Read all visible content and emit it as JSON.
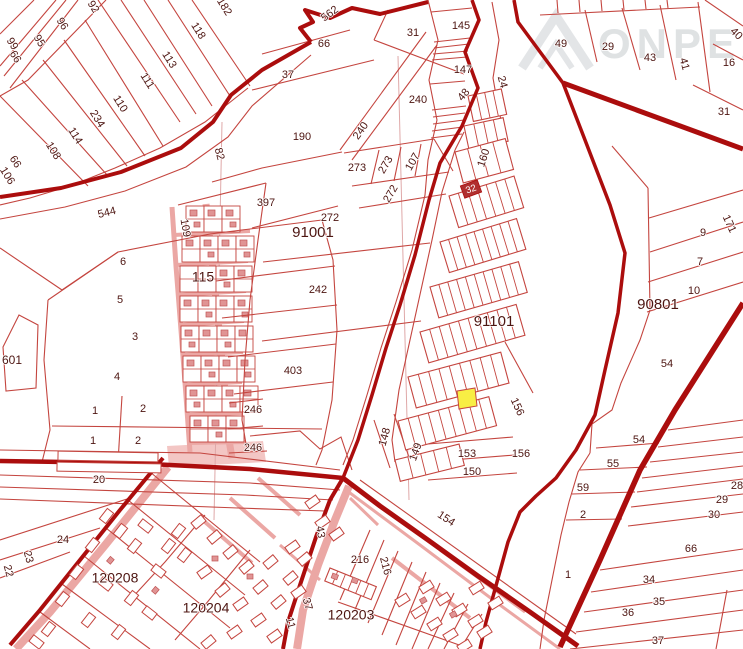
{
  "map": {
    "watermark": {
      "text": "ONPEA"
    },
    "colors": {
      "line": "#c4453f",
      "road": "#ab0d0d",
      "pink_fill": "#f3c6c4",
      "pink_line": "#eba7a4",
      "power_line": "#dfa8a8",
      "building": "#e09494",
      "building_edge": "#c05555",
      "label": "#4d1511",
      "highlight": "#f8ee44",
      "boxed_label_bg": "#b03030",
      "boxed_label_text": "#ffffff",
      "watermark": "#dcdfe1"
    },
    "boxed_label": {
      "t": "32",
      "x": 471,
      "y": 189,
      "r": -20
    },
    "highlighted_parcel": {
      "color": "#f8ee44"
    },
    "labels": [
      {
        "t": "99",
        "x": 12,
        "y": 44,
        "r": 58
      },
      {
        "t": "66",
        "x": 15,
        "y": 57,
        "r": 58
      },
      {
        "t": "95",
        "x": 39,
        "y": 41,
        "r": 58
      },
      {
        "t": "96",
        "x": 62,
        "y": 24,
        "r": 58
      },
      {
        "t": "92",
        "x": 93,
        "y": 7,
        "r": 58
      },
      {
        "t": "118",
        "x": 198,
        "y": 31,
        "r": 58
      },
      {
        "t": "113",
        "x": 169,
        "y": 60,
        "r": 58
      },
      {
        "t": "111",
        "x": 147,
        "y": 81,
        "r": 58
      },
      {
        "t": "110",
        "x": 120,
        "y": 104,
        "r": 58
      },
      {
        "t": "234",
        "x": 97,
        "y": 119,
        "r": 58
      },
      {
        "t": "114",
        "x": 75,
        "y": 136,
        "r": 58
      },
      {
        "t": "108",
        "x": 53,
        "y": 151,
        "r": 58
      },
      {
        "t": "66",
        "x": 15,
        "y": 162,
        "r": 58
      },
      {
        "t": "106",
        "x": 7,
        "y": 176,
        "r": 58
      },
      {
        "t": "182",
        "x": 224,
        "y": 7,
        "r": 58
      },
      {
        "t": "562",
        "x": 330,
        "y": 14,
        "r": -36
      },
      {
        "t": "66",
        "x": 324,
        "y": 44
      },
      {
        "t": "37",
        "x": 288,
        "y": 75
      },
      {
        "t": "31",
        "x": 413,
        "y": 33
      },
      {
        "t": "190",
        "x": 302,
        "y": 137
      },
      {
        "t": "240",
        "x": 418,
        "y": 100
      },
      {
        "t": "240",
        "x": 361,
        "y": 131,
        "r": -55
      },
      {
        "t": "273",
        "x": 357,
        "y": 168
      },
      {
        "t": "273",
        "x": 386,
        "y": 165,
        "r": -60
      },
      {
        "t": "107",
        "x": 413,
        "y": 162,
        "r": -60
      },
      {
        "t": "272",
        "x": 391,
        "y": 194,
        "r": -60
      },
      {
        "t": "272",
        "x": 330,
        "y": 218
      },
      {
        "t": "91001",
        "x": 313,
        "y": 233,
        "s": 15
      },
      {
        "t": "397",
        "x": 266,
        "y": 203
      },
      {
        "t": "242",
        "x": 318,
        "y": 290
      },
      {
        "t": "82",
        "x": 219,
        "y": 154,
        "r": 75
      },
      {
        "t": "109",
        "x": 185,
        "y": 228,
        "r": 80
      },
      {
        "t": "115",
        "x": 203,
        "y": 278,
        "s": 14
      },
      {
        "t": "544",
        "x": 107,
        "y": 213,
        "r": -14
      },
      {
        "t": "160",
        "x": 484,
        "y": 158,
        "r": -72
      },
      {
        "t": "24",
        "x": 502,
        "y": 82,
        "r": 75
      },
      {
        "t": "145",
        "x": 461,
        "y": 26
      },
      {
        "t": "147",
        "x": 463,
        "y": 70
      },
      {
        "t": "48",
        "x": 464,
        "y": 95,
        "r": -50
      },
      {
        "t": "91101",
        "x": 494,
        "y": 322,
        "s": 15
      },
      {
        "t": "49",
        "x": 561,
        "y": 44
      },
      {
        "t": "29",
        "x": 608,
        "y": 47
      },
      {
        "t": "43",
        "x": 650,
        "y": 58
      },
      {
        "t": "41",
        "x": 684,
        "y": 64,
        "r": 75
      },
      {
        "t": "16",
        "x": 729,
        "y": 63
      },
      {
        "t": "40",
        "x": 736,
        "y": 34,
        "r": 45
      },
      {
        "t": "31",
        "x": 724,
        "y": 112
      },
      {
        "t": "171",
        "x": 729,
        "y": 224,
        "r": 65
      },
      {
        "t": "9",
        "x": 703,
        "y": 233
      },
      {
        "t": "7",
        "x": 700,
        "y": 262
      },
      {
        "t": "10",
        "x": 694,
        "y": 291
      },
      {
        "t": "90801",
        "x": 658,
        "y": 305,
        "s": 15
      },
      {
        "t": "54",
        "x": 667,
        "y": 364
      },
      {
        "t": "601",
        "x": 12,
        "y": 361,
        "s": 12
      },
      {
        "t": "6",
        "x": 123,
        "y": 262
      },
      {
        "t": "5",
        "x": 120,
        "y": 300
      },
      {
        "t": "3",
        "x": 135,
        "y": 337
      },
      {
        "t": "4",
        "x": 117,
        "y": 377
      },
      {
        "t": "1",
        "x": 95,
        "y": 411
      },
      {
        "t": "2",
        "x": 143,
        "y": 409
      },
      {
        "t": "1",
        "x": 93,
        "y": 441
      },
      {
        "t": "2",
        "x": 138,
        "y": 441
      },
      {
        "t": "403",
        "x": 293,
        "y": 371
      },
      {
        "t": "246",
        "x": 253,
        "y": 410
      },
      {
        "t": "246",
        "x": 253,
        "y": 448
      },
      {
        "t": "148",
        "x": 385,
        "y": 437,
        "r": -75
      },
      {
        "t": "149",
        "x": 416,
        "y": 452,
        "r": -70
      },
      {
        "t": "153",
        "x": 467,
        "y": 454
      },
      {
        "t": "150",
        "x": 472,
        "y": 472
      },
      {
        "t": "156",
        "x": 517,
        "y": 407,
        "r": 65
      },
      {
        "t": "156",
        "x": 521,
        "y": 454
      },
      {
        "t": "20",
        "x": 99,
        "y": 480
      },
      {
        "t": "154",
        "x": 446,
        "y": 519,
        "r": 33
      },
      {
        "t": "216",
        "x": 360,
        "y": 560
      },
      {
        "t": "216",
        "x": 385,
        "y": 566,
        "r": 75
      },
      {
        "t": "43",
        "x": 320,
        "y": 532,
        "r": 80
      },
      {
        "t": "24",
        "x": 63,
        "y": 540
      },
      {
        "t": "23",
        "x": 28,
        "y": 557,
        "r": 75
      },
      {
        "t": "22",
        "x": 8,
        "y": 571,
        "r": 75
      },
      {
        "t": "120208",
        "x": 115,
        "y": 579,
        "s": 14
      },
      {
        "t": "120204",
        "x": 206,
        "y": 609,
        "s": 14
      },
      {
        "t": "120203",
        "x": 351,
        "y": 616,
        "s": 14
      },
      {
        "t": "37",
        "x": 307,
        "y": 604,
        "r": 75
      },
      {
        "t": "11",
        "x": 290,
        "y": 623,
        "r": 75
      },
      {
        "t": "54",
        "x": 639,
        "y": 440
      },
      {
        "t": "55",
        "x": 613,
        "y": 464
      },
      {
        "t": "59",
        "x": 583,
        "y": 488
      },
      {
        "t": "2",
        "x": 583,
        "y": 515
      },
      {
        "t": "1",
        "x": 568,
        "y": 575
      },
      {
        "t": "28",
        "x": 737,
        "y": 486
      },
      {
        "t": "29",
        "x": 722,
        "y": 500
      },
      {
        "t": "30",
        "x": 714,
        "y": 515
      },
      {
        "t": "66",
        "x": 691,
        "y": 549
      },
      {
        "t": "34",
        "x": 649,
        "y": 580
      },
      {
        "t": "35",
        "x": 659,
        "y": 602
      },
      {
        "t": "36",
        "x": 628,
        "y": 613
      },
      {
        "t": "37",
        "x": 658,
        "y": 641
      }
    ]
  }
}
